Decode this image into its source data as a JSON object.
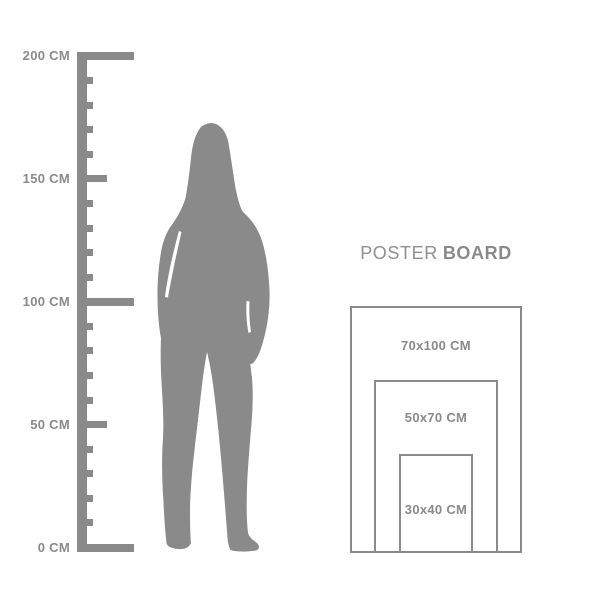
{
  "colors": {
    "figure": "#8a8a8a",
    "ruler": "#8a8a8a",
    "label_text": "#8a8a8a",
    "board_border": "#8a8a8a",
    "title_text": "#8f8f8f"
  },
  "ruler": {
    "unit": "CM",
    "min_cm": 0,
    "max_cm": 200,
    "minor_step_cm": 10,
    "labels": [
      {
        "cm": 200,
        "text": "200 CM"
      },
      {
        "cm": 150,
        "text": "150 CM"
      },
      {
        "cm": 100,
        "text": "100 CM"
      },
      {
        "cm": 50,
        "text": "50 CM"
      },
      {
        "cm": 0,
        "text": "0 CM"
      }
    ]
  },
  "figure": {
    "type": "standing-woman-silhouette"
  },
  "poster_board": {
    "title_regular": "POSTER",
    "title_bold": "BOARD",
    "sizes": [
      {
        "label": "70x100 CM",
        "width_cm": 70,
        "height_cm": 100
      },
      {
        "label": "50x70 CM",
        "width_cm": 50,
        "height_cm": 70
      },
      {
        "label": "30x40 CM",
        "width_cm": 30,
        "height_cm": 40
      }
    ]
  }
}
